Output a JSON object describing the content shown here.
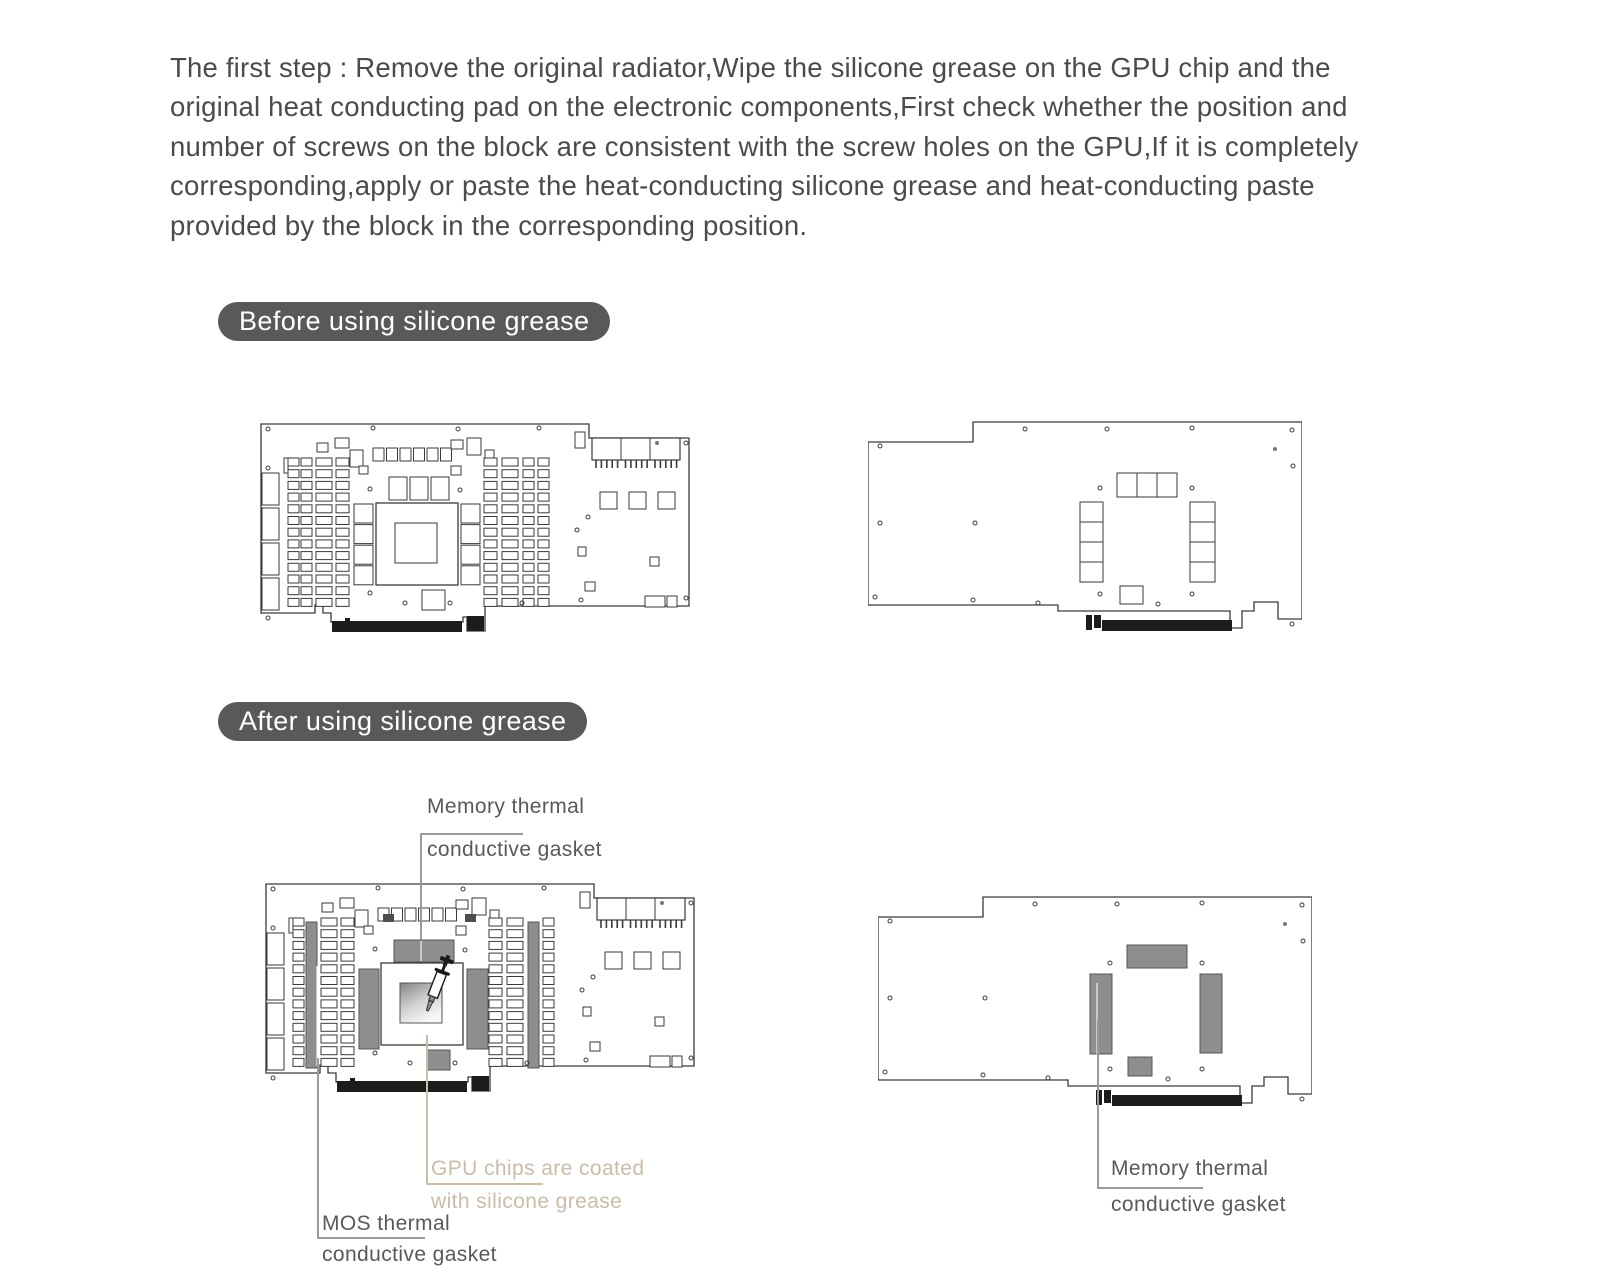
{
  "instructions": {
    "text": "The first step : Remove the original radiator,Wipe the silicone grease on the GPU chip and the original heat conducting pad on the electronic components,First check whether the position and number of screws on the block are consistent with the screw holes on the GPU,If it is completely corresponding,apply or paste the heat-conducting silicone grease and heat-conducting paste provided by the block in the corresponding position."
  },
  "sections": {
    "before": {
      "label": "Before using silicone grease"
    },
    "after": {
      "label": "After using silicone grease"
    }
  },
  "annotations": {
    "memory_top": {
      "line1": "Memory thermal",
      "line2": "conductive gasket"
    },
    "gpu": {
      "line1": "GPU chips are coated",
      "line2": "with silicone grease"
    },
    "mos": {
      "line1": "MOS thermal",
      "line2": "conductive gasket"
    },
    "memory_back": {
      "line1": "Memory thermal",
      "line2": "conductive gasket"
    }
  },
  "colors": {
    "pill_bg": "#59595b",
    "line": "#3a3a3a",
    "pad_gray": "#8e8e90",
    "pad_stroke": "#555557",
    "grease_tan": "#cabca8",
    "text": "#4b4b4b",
    "label_text": "#59595b",
    "leader_gray": "#9b9b9b"
  }
}
